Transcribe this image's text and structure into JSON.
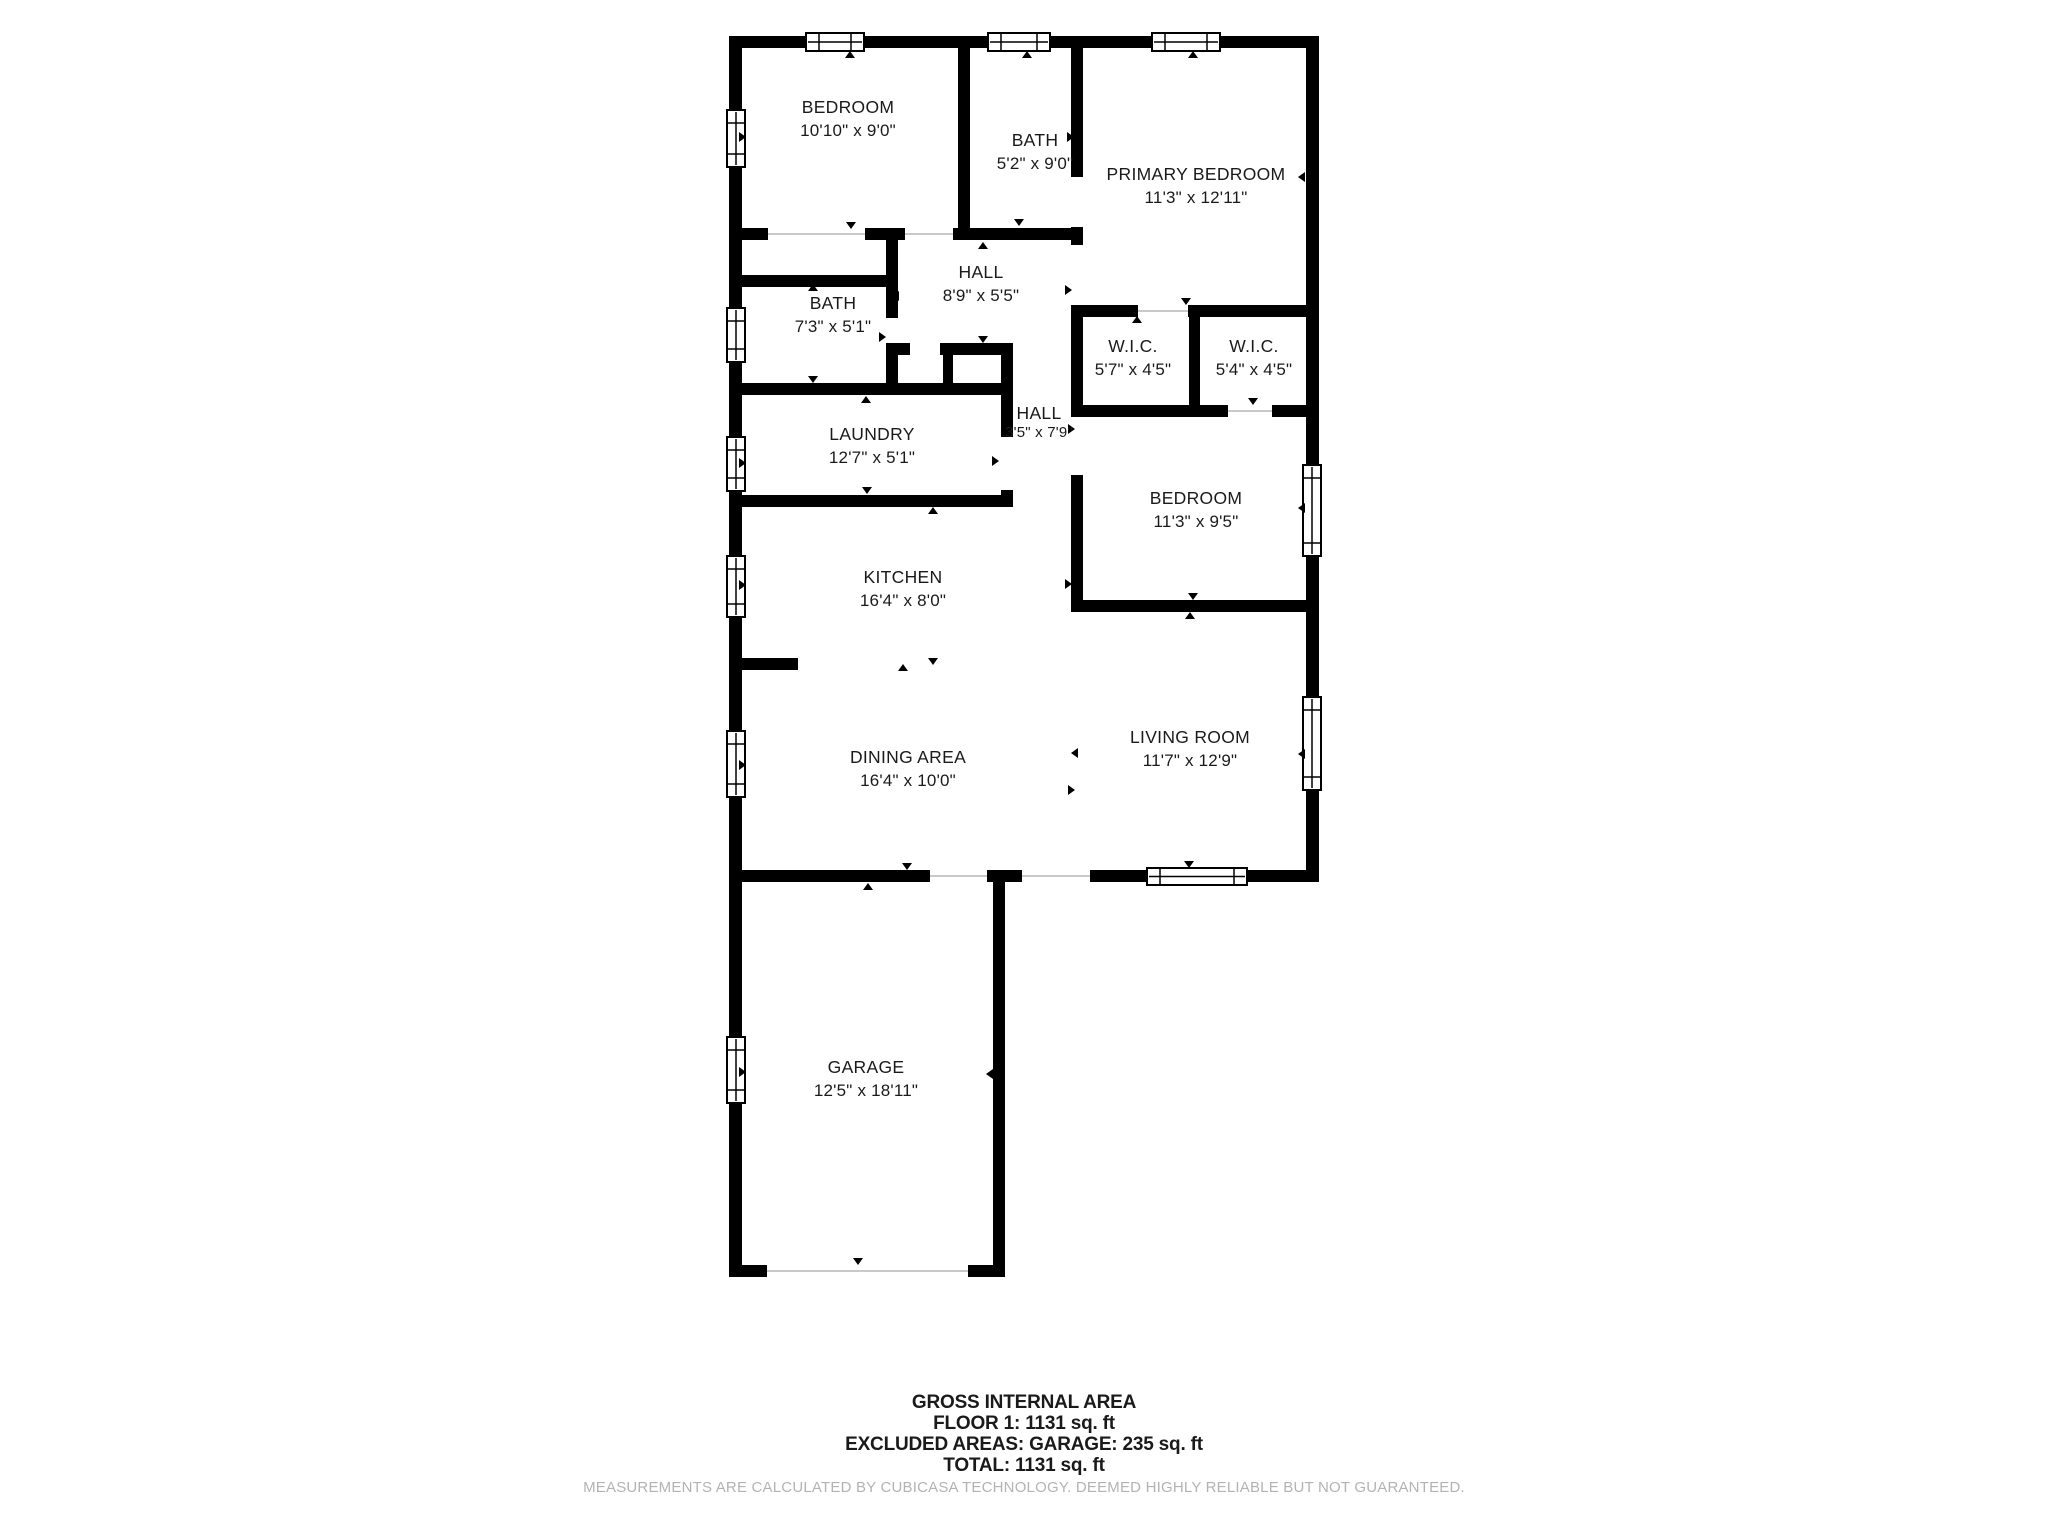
{
  "meta": {
    "title": "Floor plan - Floor 1",
    "wall_color": "#000000",
    "label_color": "#1a1a1a",
    "opening_line_color": "#c9c9c9",
    "disclaimer_color": "#b3b3b3",
    "background": "#ffffff"
  },
  "rooms": [
    {
      "name": "BEDROOM",
      "dims": "10'10\" x 9'0\"",
      "cx": 848,
      "ny": 113,
      "dy": 136
    },
    {
      "name": "BATH",
      "dims": "5'2\" x 9'0\"",
      "cx": 1035,
      "ny": 146,
      "dy": 169
    },
    {
      "name": "PRIMARY BEDROOM",
      "dims": "11'3\" x 12'11\"",
      "cx": 1196,
      "ny": 180,
      "dy": 203
    },
    {
      "name": "HALL",
      "dims": "8'9\" x 5'5\"",
      "cx": 981,
      "ny": 278,
      "dy": 301
    },
    {
      "name": "BATH",
      "dims": "7'3\" x 5'1\"",
      "cx": 833,
      "ny": 309,
      "dy": 332
    },
    {
      "name": "W.I.C.",
      "dims": "5'7\" x 4'5\"",
      "cx": 1133,
      "ny": 352,
      "dy": 375
    },
    {
      "name": "W.I.C.",
      "dims": "5'4\" x 4'5\"",
      "cx": 1254,
      "ny": 352,
      "dy": 375
    },
    {
      "name": "LAUNDRY",
      "dims": "12'7\" x 5'1\"",
      "cx": 872,
      "ny": 440,
      "dy": 463
    },
    {
      "name": "HALL",
      "dims": "3'5\" x 7'9\"",
      "cx": 1039,
      "ny": 419,
      "dy": 437,
      "small": true
    },
    {
      "name": "BEDROOM",
      "dims": "11'3\" x 9'5\"",
      "cx": 1196,
      "ny": 504,
      "dy": 527
    },
    {
      "name": "KITCHEN",
      "dims": "16'4\" x 8'0\"",
      "cx": 903,
      "ny": 583,
      "dy": 606
    },
    {
      "name": "DINING AREA",
      "dims": "16'4\" x 10'0\"",
      "cx": 908,
      "ny": 763,
      "dy": 786
    },
    {
      "name": "LIVING ROOM",
      "dims": "11'7\" x 12'9\"",
      "cx": 1190,
      "ny": 743,
      "dy": 766
    },
    {
      "name": "GARAGE",
      "dims": "12'5\" x 18'11\"",
      "cx": 866,
      "ny": 1073,
      "dy": 1096
    }
  ],
  "floorplan": {
    "walls": [
      [
        729,
        36,
        590,
        12
      ],
      [
        729,
        36,
        13,
        846
      ],
      [
        1306,
        36,
        13,
        846
      ],
      [
        729,
        870,
        201,
        12
      ],
      [
        987,
        870,
        35,
        12
      ],
      [
        1090,
        870,
        60,
        12
      ],
      [
        1245,
        870,
        74,
        12
      ],
      [
        729,
        882,
        13,
        395
      ],
      [
        993,
        882,
        12,
        395
      ],
      [
        729,
        1265,
        38,
        12
      ],
      [
        968,
        1265,
        37,
        12
      ],
      [
        958,
        48,
        12,
        181
      ],
      [
        1071,
        48,
        12,
        129
      ],
      [
        1071,
        227,
        12,
        18
      ],
      [
        729,
        228,
        39,
        12
      ],
      [
        865,
        228,
        40,
        12
      ],
      [
        953,
        228,
        130,
        12
      ],
      [
        886,
        228,
        12,
        59
      ],
      [
        729,
        275,
        169,
        12
      ],
      [
        886,
        287,
        12,
        31
      ],
      [
        886,
        352,
        12,
        43
      ],
      [
        886,
        343,
        24,
        12
      ],
      [
        940,
        343,
        73,
        12
      ],
      [
        943,
        343,
        10,
        52
      ],
      [
        729,
        383,
        284,
        12
      ],
      [
        1001,
        343,
        12,
        94
      ],
      [
        1001,
        490,
        12,
        17
      ],
      [
        729,
        495,
        284,
        12
      ],
      [
        1071,
        305,
        67,
        12
      ],
      [
        1188,
        305,
        131,
        12
      ],
      [
        1189,
        317,
        11,
        100
      ],
      [
        1071,
        317,
        12,
        88
      ],
      [
        1071,
        405,
        157,
        12
      ],
      [
        1272,
        405,
        47,
        12
      ],
      [
        1071,
        475,
        12,
        137
      ],
      [
        1071,
        600,
        248,
        12
      ],
      [
        742,
        658,
        56,
        12
      ]
    ],
    "windows": [
      [
        727,
        110,
        18,
        57,
        "v"
      ],
      [
        727,
        308,
        18,
        54,
        "v"
      ],
      [
        727,
        437,
        18,
        54,
        "v"
      ],
      [
        727,
        556,
        18,
        61,
        "v"
      ],
      [
        727,
        731,
        18,
        66,
        "v"
      ],
      [
        727,
        1037,
        18,
        66,
        "v"
      ],
      [
        1303,
        465,
        18,
        91,
        "v"
      ],
      [
        1303,
        697,
        18,
        93,
        "v"
      ],
      [
        806,
        33,
        58,
        18,
        "h"
      ],
      [
        988,
        33,
        62,
        18,
        "h"
      ],
      [
        1152,
        33,
        68,
        18,
        "h"
      ],
      [
        1147,
        868,
        100,
        17,
        "h"
      ]
    ],
    "opening_lines": [
      [
        768,
        234,
        865,
        234
      ],
      [
        905,
        234,
        953,
        234
      ],
      [
        1138,
        311,
        1188,
        311
      ],
      [
        1228,
        411,
        1272,
        411
      ],
      [
        930,
        876,
        987,
        876
      ],
      [
        1022,
        876,
        1090,
        876
      ],
      [
        767,
        1271,
        968,
        1271
      ]
    ],
    "triangles": [
      [
        850,
        55,
        "up"
      ],
      [
        1027,
        55,
        "up"
      ],
      [
        1193,
        55,
        "up"
      ],
      [
        742,
        137,
        "right"
      ],
      [
        1070,
        137,
        "right"
      ],
      [
        1302,
        177,
        "left"
      ],
      [
        851,
        225,
        "down"
      ],
      [
        1019,
        222,
        "down"
      ],
      [
        983,
        246,
        "up"
      ],
      [
        896,
        296,
        "left"
      ],
      [
        1068,
        290,
        "right"
      ],
      [
        813,
        288,
        "up"
      ],
      [
        882,
        337,
        "right"
      ],
      [
        983,
        339,
        "down"
      ],
      [
        813,
        379,
        "down"
      ],
      [
        866,
        400,
        "up"
      ],
      [
        742,
        463,
        "right"
      ],
      [
        995,
        461,
        "right"
      ],
      [
        867,
        490,
        "down"
      ],
      [
        933,
        511,
        "up"
      ],
      [
        1137,
        320,
        "up"
      ],
      [
        1186,
        301,
        "down"
      ],
      [
        1253,
        401,
        "down"
      ],
      [
        1077,
        490,
        "left"
      ],
      [
        1302,
        508,
        "left"
      ],
      [
        1193,
        596,
        "down"
      ],
      [
        1190,
        616,
        "up"
      ],
      [
        742,
        585,
        "right"
      ],
      [
        1068,
        584,
        "right"
      ],
      [
        903,
        668,
        "up"
      ],
      [
        933,
        661,
        "down"
      ],
      [
        1075,
        753,
        "left"
      ],
      [
        1071,
        790,
        "right"
      ],
      [
        742,
        765,
        "right"
      ],
      [
        1302,
        754,
        "left"
      ],
      [
        907,
        866,
        "down"
      ],
      [
        868,
        887,
        "up"
      ],
      [
        1189,
        864,
        "down"
      ],
      [
        742,
        1072,
        "right"
      ],
      [
        990,
        1074,
        "left"
      ],
      [
        858,
        1261,
        "down"
      ],
      [
        1006,
        429,
        "left"
      ],
      [
        1071,
        429,
        "right"
      ]
    ]
  },
  "footer": {
    "lines": [
      "GROSS INTERNAL AREA",
      "FLOOR 1: 1131 sq. ft",
      "EXCLUDED AREAS: GARAGE: 235 sq. ft",
      "TOTAL: 1131 sq. ft"
    ],
    "disclaimer": "MEASUREMENTS ARE CALCULATED BY CUBICASA TECHNOLOGY. DEEMED HIGHLY RELIABLE BUT NOT GUARANTEED."
  }
}
